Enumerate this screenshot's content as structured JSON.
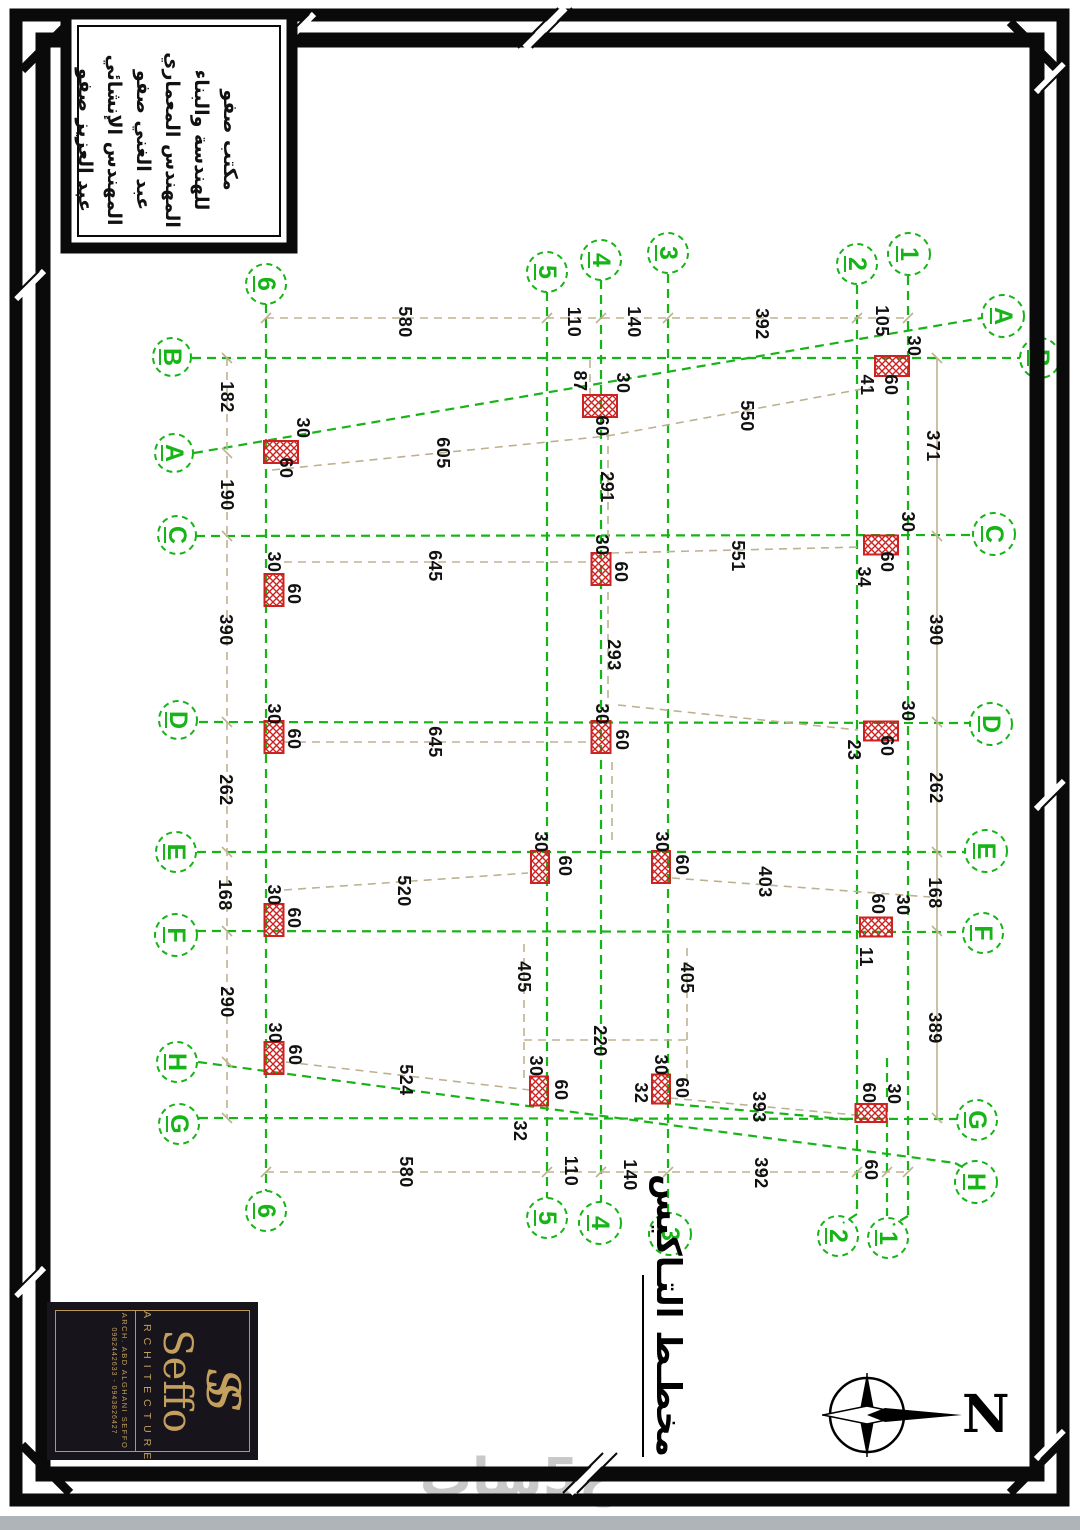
{
  "title_block": {
    "lines": [
      "مكتب صفو",
      "للهندسة والبناء",
      "المهندس المعماري",
      "عبد الغني صفو",
      "المهندس الإنشائي",
      "عبد العزيز صفو"
    ]
  },
  "logo": {
    "monogram": "SS",
    "name": "Seffo",
    "tagline": "ARCHITECTURE",
    "subtitle": "ARCH. ABD ALGHANI SEFFO",
    "phones": "0982442633 - 0943826427"
  },
  "drawing_title": {
    "text": "مخطـط التـاكيس"
  },
  "north": {
    "label": "N"
  },
  "watermark": {
    "text": "خ5سات"
  },
  "colors": {
    "grid_green": "#17b417",
    "dim_tan": "#bdb290",
    "column_red": "#cc2222",
    "ink": "#111111",
    "gold": "#c3a05e"
  },
  "plan": {
    "v_grids": [
      {
        "label": "6",
        "x": 266,
        "y1": 304,
        "y2": 1191,
        "top": {
          "x": 266,
          "y": 284,
          "r": 20
        },
        "bot": {
          "x": 266,
          "y": 1211,
          "r": 20
        }
      },
      {
        "label": "5",
        "x": 547,
        "y1": 292,
        "y2": 1198,
        "top": {
          "x": 547,
          "y": 272,
          "r": 20
        },
        "bot": {
          "x": 547,
          "y": 1218,
          "r": 20
        }
      },
      {
        "label": "4",
        "x": 601,
        "y1": 280,
        "y2": 1202,
        "top": {
          "x": 601,
          "y": 260,
          "r": 20
        },
        "bot": {
          "x": 600,
          "y": 1223,
          "r": 21
        }
      },
      {
        "label": "3",
        "x": 668,
        "y1": 274,
        "y2": 1213,
        "top": {
          "x": 668,
          "y": 253,
          "r": 20
        },
        "bot": {
          "x": 670,
          "y": 1234,
          "r": 21
        }
      },
      {
        "label": "2",
        "x": 857,
        "y1": 285,
        "y2": 1214,
        "top": {
          "x": 857,
          "y": 264,
          "r": 20
        },
        "bot": {
          "x": 838,
          "y": 1236,
          "r": 20
        }
      },
      {
        "label": "1",
        "x": 908,
        "y1": 276,
        "y2": 1216,
        "top": {
          "x": 909,
          "y": 254,
          "r": 21
        },
        "bot": {
          "x": 888,
          "y": 1238,
          "r": 20
        }
      }
    ],
    "h_grids": [
      {
        "label": "B",
        "x1": 192,
        "y1": 358,
        "x2": 1020,
        "y2": 358,
        "left": {
          "x": 172,
          "y": 357,
          "r": 19
        },
        "right": {
          "x": 1040,
          "y": 358,
          "r": 20
        }
      },
      {
        "label": "A",
        "x1": 194,
        "y1": 453,
        "x2": 982,
        "y2": 318,
        "left": {
          "x": 174,
          "y": 453,
          "r": 19
        },
        "right": {
          "x": 1003,
          "y": 316,
          "r": 21
        }
      },
      {
        "label": "C",
        "x1": 196,
        "y1": 536,
        "x2": 973,
        "y2": 535,
        "left": {
          "x": 177,
          "y": 535,
          "r": 19
        },
        "right": {
          "x": 994,
          "y": 534,
          "r": 21
        }
      },
      {
        "label": "D",
        "x1": 199,
        "y1": 722,
        "x2": 970,
        "y2": 723,
        "left": {
          "x": 178,
          "y": 720,
          "r": 19
        },
        "right": {
          "x": 991,
          "y": 724,
          "r": 21
        }
      },
      {
        "label": "E",
        "x1": 197,
        "y1": 852,
        "x2": 965,
        "y2": 852,
        "left": {
          "x": 176,
          "y": 852,
          "r": 20
        },
        "right": {
          "x": 986,
          "y": 851,
          "r": 21
        }
      },
      {
        "label": "F",
        "x1": 197,
        "y1": 931,
        "x2": 963,
        "y2": 932,
        "left": {
          "x": 176,
          "y": 935,
          "r": 21
        },
        "right": {
          "x": 983,
          "y": 933,
          "r": 20
        }
      },
      {
        "label": "G",
        "x1": 199,
        "y1": 1118,
        "x2": 957,
        "y2": 1119,
        "left": {
          "x": 179,
          "y": 1124,
          "r": 20
        },
        "right": {
          "x": 977,
          "y": 1120,
          "r": 20
        }
      },
      {
        "label": "H",
        "x1": 198,
        "y1": 1062,
        "x2": 955,
        "y2": 1163,
        "left": {
          "x": 177,
          "y": 1062,
          "r": 20
        },
        "right": {
          "x": 976,
          "y": 1182,
          "r": 21
        }
      }
    ],
    "extra_green": [
      {
        "x1": 887,
        "y1": 1058,
        "x2": 887,
        "y2": 1216
      },
      {
        "x1": 660,
        "y1": 1103,
        "x2": 855,
        "y2": 1120
      },
      {
        "x1": 857,
        "y1": 1214,
        "x2": 843,
        "y2": 1223
      },
      {
        "x1": 908,
        "y1": 1216,
        "x2": 893,
        "y2": 1225
      },
      {
        "x1": 955,
        "y1": 1163,
        "x2": 968,
        "y2": 1170
      }
    ],
    "dim_chains": [
      {
        "x1": 266,
        "y1": 318,
        "x2": 908,
        "y2": 318,
        "dashed": true,
        "ticks_x": [
          266,
          547,
          601,
          668,
          857,
          908
        ]
      },
      {
        "x1": 266,
        "y1": 1172,
        "x2": 908,
        "y2": 1172,
        "dashed": true,
        "ticks_x": [
          266,
          547,
          601,
          668,
          857,
          887,
          908
        ]
      },
      {
        "x1": 227,
        "y1": 358,
        "x2": 227,
        "y2": 1118,
        "dashed": true,
        "ticks_y": [
          358,
          453,
          536,
          722,
          852,
          931,
          1062,
          1118
        ]
      },
      {
        "x1": 937,
        "y1": 358,
        "x2": 937,
        "y2": 1118,
        "dashed": false,
        "ticks_y": [
          358,
          536,
          722,
          852,
          931,
          1118
        ]
      }
    ],
    "dim_lines": [
      {
        "x1": 284,
        "y1": 562,
        "x2": 592,
        "y2": 562
      },
      {
        "x1": 284,
        "y1": 742,
        "x2": 592,
        "y2": 742
      },
      {
        "x1": 611,
        "y1": 553,
        "x2": 862,
        "y2": 547
      },
      {
        "x1": 618,
        "y1": 705,
        "x2": 858,
        "y2": 730
      },
      {
        "x1": 608,
        "y1": 432,
        "x2": 608,
        "y2": 543
      },
      {
        "x1": 608,
        "y1": 592,
        "x2": 608,
        "y2": 716
      },
      {
        "x1": 612,
        "y1": 762,
        "x2": 612,
        "y2": 846
      },
      {
        "x1": 590,
        "y1": 360,
        "x2": 590,
        "y2": 398
      },
      {
        "x1": 272,
        "y1": 470,
        "x2": 607,
        "y2": 436
      },
      {
        "x1": 607,
        "y1": 436,
        "x2": 873,
        "y2": 387
      },
      {
        "x1": 672,
        "y1": 878,
        "x2": 930,
        "y2": 897
      },
      {
        "x1": 524,
        "y1": 944,
        "x2": 524,
        "y2": 1078
      },
      {
        "x1": 687,
        "y1": 948,
        "x2": 687,
        "y2": 1080
      },
      {
        "x1": 524,
        "y1": 1040,
        "x2": 687,
        "y2": 1040
      },
      {
        "x1": 284,
        "y1": 890,
        "x2": 528,
        "y2": 873
      },
      {
        "x1": 286,
        "y1": 1062,
        "x2": 530,
        "y2": 1090
      },
      {
        "x1": 670,
        "y1": 1098,
        "x2": 855,
        "y2": 1115
      }
    ],
    "columns": [
      {
        "x": 892,
        "y": 366,
        "w": 34,
        "h": 20
      },
      {
        "x": 600,
        "y": 406,
        "w": 34,
        "h": 22
      },
      {
        "x": 281,
        "y": 452,
        "w": 34,
        "h": 22
      },
      {
        "x": 881,
        "y": 545,
        "w": 34,
        "h": 19
      },
      {
        "x": 274,
        "y": 590,
        "w": 19,
        "h": 32
      },
      {
        "x": 601,
        "y": 569,
        "w": 19,
        "h": 32
      },
      {
        "x": 881,
        "y": 731,
        "w": 34,
        "h": 19
      },
      {
        "x": 274,
        "y": 737,
        "w": 19,
        "h": 32
      },
      {
        "x": 601,
        "y": 737,
        "w": 19,
        "h": 32
      },
      {
        "x": 540,
        "y": 867,
        "w": 18,
        "h": 32
      },
      {
        "x": 661,
        "y": 867,
        "w": 18,
        "h": 32
      },
      {
        "x": 876,
        "y": 927,
        "w": 32,
        "h": 19
      },
      {
        "x": 274,
        "y": 920,
        "w": 19,
        "h": 32
      },
      {
        "x": 274,
        "y": 1058,
        "w": 19,
        "h": 32
      },
      {
        "x": 539,
        "y": 1091,
        "w": 18,
        "h": 29
      },
      {
        "x": 661,
        "y": 1089,
        "w": 18,
        "h": 29
      },
      {
        "x": 871,
        "y": 1113,
        "w": 31,
        "h": 18
      }
    ],
    "dim_labels": [
      {
        "t": "580",
        "x": 405,
        "y": 322
      },
      {
        "t": "110",
        "x": 574,
        "y": 322
      },
      {
        "t": "140",
        "x": 634,
        "y": 322
      },
      {
        "t": "392",
        "x": 762,
        "y": 324
      },
      {
        "t": "105",
        "x": 882,
        "y": 321
      },
      {
        "t": "30",
        "x": 914,
        "y": 346
      },
      {
        "t": "60",
        "x": 891,
        "y": 385
      },
      {
        "t": "41",
        "x": 867,
        "y": 385
      },
      {
        "t": "371",
        "x": 933,
        "y": 446
      },
      {
        "t": "87",
        "x": 580,
        "y": 381
      },
      {
        "t": "30",
        "x": 623,
        "y": 383
      },
      {
        "t": "60",
        "x": 602,
        "y": 426
      },
      {
        "t": "291",
        "x": 607,
        "y": 487
      },
      {
        "t": "550",
        "x": 747,
        "y": 416
      },
      {
        "t": "605",
        "x": 443,
        "y": 453
      },
      {
        "t": "182",
        "x": 227,
        "y": 397
      },
      {
        "t": "190",
        "x": 227,
        "y": 495
      },
      {
        "t": "30",
        "x": 303,
        "y": 428
      },
      {
        "t": "60",
        "x": 286,
        "y": 468
      },
      {
        "t": "390",
        "x": 226,
        "y": 630
      },
      {
        "t": "390",
        "x": 936,
        "y": 630
      },
      {
        "t": "30",
        "x": 908,
        "y": 522
      },
      {
        "t": "60",
        "x": 887,
        "y": 562
      },
      {
        "t": "34",
        "x": 864,
        "y": 577
      },
      {
        "t": "645",
        "x": 435,
        "y": 566
      },
      {
        "t": "551",
        "x": 738,
        "y": 556
      },
      {
        "t": "293",
        "x": 614,
        "y": 655
      },
      {
        "t": "30",
        "x": 274,
        "y": 562
      },
      {
        "t": "60",
        "x": 294,
        "y": 594
      },
      {
        "t": "30",
        "x": 602,
        "y": 545
      },
      {
        "t": "60",
        "x": 621,
        "y": 572
      },
      {
        "t": "645",
        "x": 435,
        "y": 742
      },
      {
        "t": "30",
        "x": 908,
        "y": 711
      },
      {
        "t": "60",
        "x": 887,
        "y": 746
      },
      {
        "t": "23",
        "x": 854,
        "y": 750
      },
      {
        "t": "30",
        "x": 274,
        "y": 714
      },
      {
        "t": "60",
        "x": 294,
        "y": 739
      },
      {
        "t": "30",
        "x": 602,
        "y": 714
      },
      {
        "t": "60",
        "x": 622,
        "y": 740
      },
      {
        "t": "262",
        "x": 226,
        "y": 790
      },
      {
        "t": "262",
        "x": 936,
        "y": 788
      },
      {
        "t": "30",
        "x": 541,
        "y": 842
      },
      {
        "t": "60",
        "x": 565,
        "y": 866
      },
      {
        "t": "30",
        "x": 662,
        "y": 842
      },
      {
        "t": "60",
        "x": 682,
        "y": 865
      },
      {
        "t": "403",
        "x": 765,
        "y": 882
      },
      {
        "t": "168",
        "x": 225,
        "y": 895
      },
      {
        "t": "168",
        "x": 935,
        "y": 893
      },
      {
        "t": "60",
        "x": 878,
        "y": 904
      },
      {
        "t": "30",
        "x": 903,
        "y": 905
      },
      {
        "t": "11",
        "x": 866,
        "y": 957
      },
      {
        "t": "30",
        "x": 274,
        "y": 895
      },
      {
        "t": "60",
        "x": 294,
        "y": 918
      },
      {
        "t": "520",
        "x": 404,
        "y": 891
      },
      {
        "t": "290",
        "x": 227,
        "y": 1002
      },
      {
        "t": "389",
        "x": 935,
        "y": 1028
      },
      {
        "t": "405",
        "x": 524,
        "y": 977
      },
      {
        "t": "405",
        "x": 687,
        "y": 978
      },
      {
        "t": "220",
        "x": 600,
        "y": 1041
      },
      {
        "t": "30",
        "x": 275,
        "y": 1033
      },
      {
        "t": "60",
        "x": 295,
        "y": 1055
      },
      {
        "t": "524",
        "x": 406,
        "y": 1080
      },
      {
        "t": "30",
        "x": 536,
        "y": 1066
      },
      {
        "t": "60",
        "x": 561,
        "y": 1090
      },
      {
        "t": "32",
        "x": 520,
        "y": 1131
      },
      {
        "t": "30",
        "x": 661,
        "y": 1065
      },
      {
        "t": "60",
        "x": 682,
        "y": 1088
      },
      {
        "t": "32",
        "x": 641,
        "y": 1093
      },
      {
        "t": "393",
        "x": 759,
        "y": 1107
      },
      {
        "t": "60",
        "x": 869,
        "y": 1093
      },
      {
        "t": "30",
        "x": 894,
        "y": 1094
      },
      {
        "t": "580",
        "x": 406,
        "y": 1172
      },
      {
        "t": "110",
        "x": 571,
        "y": 1171
      },
      {
        "t": "140",
        "x": 630,
        "y": 1175
      },
      {
        "t": "392",
        "x": 761,
        "y": 1173
      },
      {
        "t": "60",
        "x": 871,
        "y": 1170
      }
    ]
  }
}
